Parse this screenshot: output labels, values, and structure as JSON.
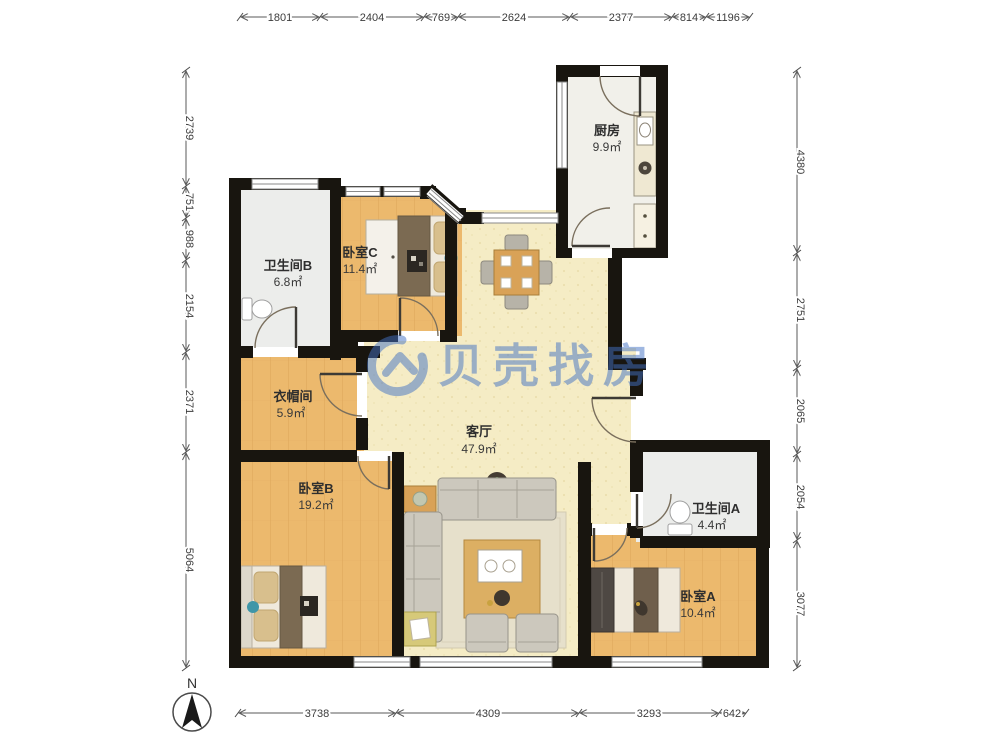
{
  "watermark": {
    "brand": "贝壳找房",
    "color": "#4272c4"
  },
  "compass": {
    "north_label": "N"
  },
  "rooms": {
    "kitchen": {
      "name": "厨房",
      "area": "9.9㎡"
    },
    "bathroom_b": {
      "name": "卫生间B",
      "area": "6.8㎡"
    },
    "bedroom_c": {
      "name": "卧室C",
      "area": "11.4㎡"
    },
    "cloakroom": {
      "name": "衣帽间",
      "area": "5.9㎡"
    },
    "living_room": {
      "name": "客厅",
      "area": "47.9㎡"
    },
    "bedroom_b": {
      "name": "卧室B",
      "area": "19.2㎡"
    },
    "bathroom_a": {
      "name": "卫生间A",
      "area": "4.4㎡"
    },
    "bedroom_a": {
      "name": "卧室A",
      "area": "10.4㎡"
    }
  },
  "dimensions_mm": {
    "top": [
      "1801",
      "2404",
      "769",
      "2624",
      "2377",
      "814",
      "1196"
    ],
    "left": [
      "2739",
      "751",
      "988",
      "2154",
      "2371",
      "5064"
    ],
    "right": [
      "4380",
      "2751",
      "2065",
      "2054",
      "3077"
    ],
    "bottom": [
      "3738",
      "4309",
      "3293",
      "642"
    ]
  }
}
